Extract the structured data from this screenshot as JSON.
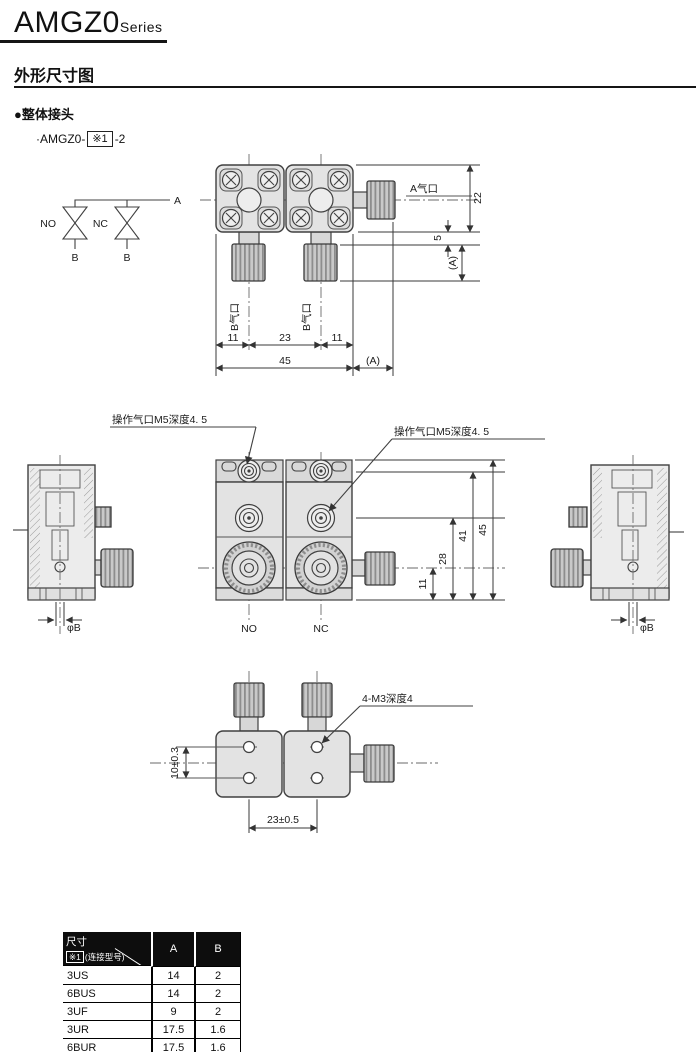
{
  "colors": {
    "line": "#404040",
    "body_fill": "#e3e3e3",
    "plate_fill": "#d9d9d9",
    "knurl_fill": "#c9c9c9",
    "table_header_bg": "#0d0d0d"
  },
  "header": {
    "series_name": "AMGZ0",
    "series_suffix": "Series"
  },
  "section_title": "外形尺寸图",
  "subsection": {
    "bullet_title": "●整体接头",
    "model_prefix": "·AMGZ0-",
    "model_box": "※1",
    "model_suffix": "-2"
  },
  "schematic": {
    "valve_no": "NO",
    "valve_nc": "NC",
    "port_a": "A",
    "port_b_left": "B",
    "port_b_right": "B"
  },
  "top_view": {
    "port_a_label": "A气口",
    "port_b_left_label": "B气口",
    "port_b_right_label": "B气口",
    "dims": {
      "height": "22",
      "offset": "5",
      "ext_a_vertical": "(A)",
      "left": "11",
      "center": "23",
      "right": "11",
      "total_width": "45",
      "ext_a_horizontal": "(A)"
    }
  },
  "front_view": {
    "op_port_left_label": "操作气口M5深度4. 5",
    "op_port_right_label": "操作气口M5深度4. 5",
    "valve_no": "NO",
    "valve_nc": "NC",
    "dims": {
      "total_height": "45",
      "body_height": "41",
      "mid_port_height": "28",
      "knob_height": "11"
    }
  },
  "left_side_view": {
    "dim_phi_b": "φB"
  },
  "right_side_view": {
    "dim_phi_b": "φB"
  },
  "bottom_view": {
    "thread_label": "4-M3深度4",
    "dims": {
      "hole_spacing_v": "10±0.3",
      "hole_spacing_h": "23±0.5"
    }
  },
  "spec_table": {
    "corner": {
      "line1": "尺寸",
      "box": "※1",
      "line2": "(连接型号)"
    },
    "columns": [
      "A",
      "B"
    ],
    "rows": [
      {
        "model": "3US",
        "a": "14",
        "b": "2"
      },
      {
        "model": "6BUS",
        "a": "14",
        "b": "2"
      },
      {
        "model": "3UF",
        "a": "9",
        "b": "2"
      },
      {
        "model": "3UR",
        "a": "17.5",
        "b": "1.6"
      },
      {
        "model": "6BUR",
        "a": "17.5",
        "b": "1.6"
      }
    ]
  }
}
